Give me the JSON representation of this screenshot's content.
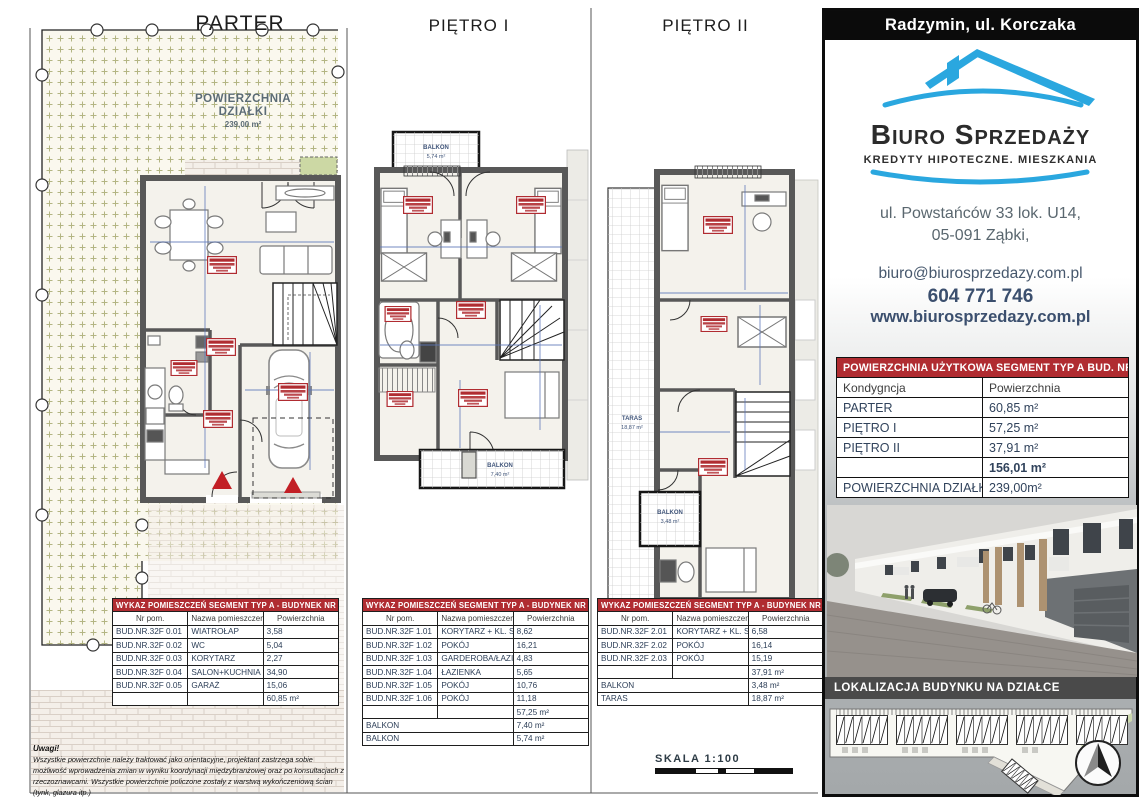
{
  "plans": {
    "parter": {
      "title": "PARTER",
      "plot_line1": "POWIERZCHNIA",
      "plot_line2": "DZIAŁKI",
      "plot_value": "239,00 m²"
    },
    "pietro1": {
      "title": "PIĘTRO I",
      "balkon_top_label": "BALKON",
      "balkon_top_value": "5,74 m²",
      "balkon_bottom_label": "BALKON",
      "balkon_bottom_value": "7,40 m²"
    },
    "pietro2": {
      "title": "PIĘTRO II",
      "taras_label": "TARAS",
      "taras_value": "18,87 m²",
      "balkon_label": "BALKON",
      "balkon_value": "3,48 m²"
    }
  },
  "room_tables": {
    "parter": {
      "header": "WYKAZ POMIESZCZEŃ SEGMENT TYP A - BUDYNEK NR 32F",
      "columns": [
        "Nr pom.",
        "Nazwa pomieszczenia",
        "Powierzchnia"
      ],
      "rows": [
        [
          "BUD.NR.32F 0.01",
          "WIATROŁAP",
          "3,58"
        ],
        [
          "BUD.NR.32F 0.02",
          "WC",
          "5,04"
        ],
        [
          "BUD.NR.32F 0.03",
          "KORYTARZ",
          "2,27"
        ],
        [
          "BUD.NR.32F 0.04",
          "SALON+KUCHNIA",
          "34,90"
        ],
        [
          "BUD.NR.32F 0.05",
          "GARAŻ",
          "15,06"
        ]
      ],
      "total": "60,85 m²",
      "extras": []
    },
    "pietro1": {
      "header": "WYKAZ POMIESZCZEŃ SEGMENT TYP A - BUDYNEK NR 32F",
      "columns": [
        "Nr pom.",
        "Nazwa pomieszczenia",
        "Powierzchnia"
      ],
      "rows": [
        [
          "BUD.NR.32F 1.01",
          "KORYTARZ + KL. SCH.",
          "8,62"
        ],
        [
          "BUD.NR.32F 1.02",
          "POKÓJ",
          "16,21"
        ],
        [
          "BUD.NR.32F 1.03",
          "GARDEROBA/ŁAZIENKA",
          "4,83"
        ],
        [
          "BUD.NR.32F 1.04",
          "ŁAZIENKA",
          "5,65"
        ],
        [
          "BUD.NR.32F 1.05",
          "POKÓJ",
          "10,76"
        ],
        [
          "BUD.NR.32F 1.06",
          "POKÓJ",
          "11,18"
        ]
      ],
      "total": "57,25 m²",
      "extras": [
        [
          "BALKON",
          "7,40 m²"
        ],
        [
          "BALKON",
          "5,74 m²"
        ]
      ]
    },
    "pietro2": {
      "header": "WYKAZ POMIESZCZEŃ SEGMENT TYP A - BUDYNEK NR 32F",
      "columns": [
        "Nr pom.",
        "Nazwa pomieszczenia",
        "Powierzchnia"
      ],
      "rows": [
        [
          "BUD.NR.32F 2.01",
          "KORYTARZ + KL. SCH.",
          "6,58"
        ],
        [
          "BUD.NR.32F 2.02",
          "POKÓJ",
          "16,14"
        ],
        [
          "BUD.NR.32F 2.03",
          "POKÓJ",
          "15,19"
        ]
      ],
      "total": "37,91 m²",
      "extras": [
        [
          "BALKON",
          "3,48 m²"
        ],
        [
          "TARAS",
          "18,87 m²"
        ]
      ]
    }
  },
  "scale_label": "SKALA 1:100",
  "notes": {
    "title": "Uwagi!",
    "body": "Wszystkie powierzchnie należy traktować jako orientacyjne, projektant zastrzega sobie możliwość wprowadzenia zmian w wyniku koordynacji międzybranżowej oraz po konsultacjach z rzeczoznawcami. Wszystkie powierzchnie policzone zostały z warstwą wykończeniową ścian (tynk, glazura itp.)"
  },
  "sidebar": {
    "location_header": "Radzymin, ul. Korczaka",
    "logo": {
      "name": "Biuro Sprzedaży",
      "tagline": "KREDYTY HIPOTECZNE. MIESZKANIA"
    },
    "address_line1": "ul. Powstańców 33 lok. U14,",
    "address_line2": "05-091 Ząbki,",
    "email": "biuro@biurosprzedazy.com.pl",
    "phone": "604 771 746",
    "website": "www.biurosprzedazy.com.pl",
    "area_table": {
      "header": "POWIERZCHNIA UŻYTKOWA SEGMENT TYP A BUD. NR 32F",
      "columns": [
        "Kondygncja",
        "Powierzchnia"
      ],
      "rows": [
        [
          "PARTER",
          "60,85 m²"
        ],
        [
          "PIĘTRO I",
          "57,25 m²"
        ],
        [
          "PIĘTRO II",
          "37,91 m²"
        ],
        [
          "",
          "156,01 m²"
        ],
        [
          "POWIERZCHNIA DZIAŁKI",
          "239,00m²"
        ]
      ]
    },
    "location_plan_header": "LOKALIZACJA BUDYNKU NA DZIAŁCE"
  },
  "colors": {
    "table_header_red": "#b02c31",
    "logo_blue": "#2aa7df",
    "contact_navy": "#3b4f6e",
    "wall_gray": "#585858",
    "plot_cross_olive": "#b3b583",
    "entrance_red": "#c21f25",
    "dim_blue": "#5b76b8",
    "band_gray": "#4a4a4a"
  }
}
